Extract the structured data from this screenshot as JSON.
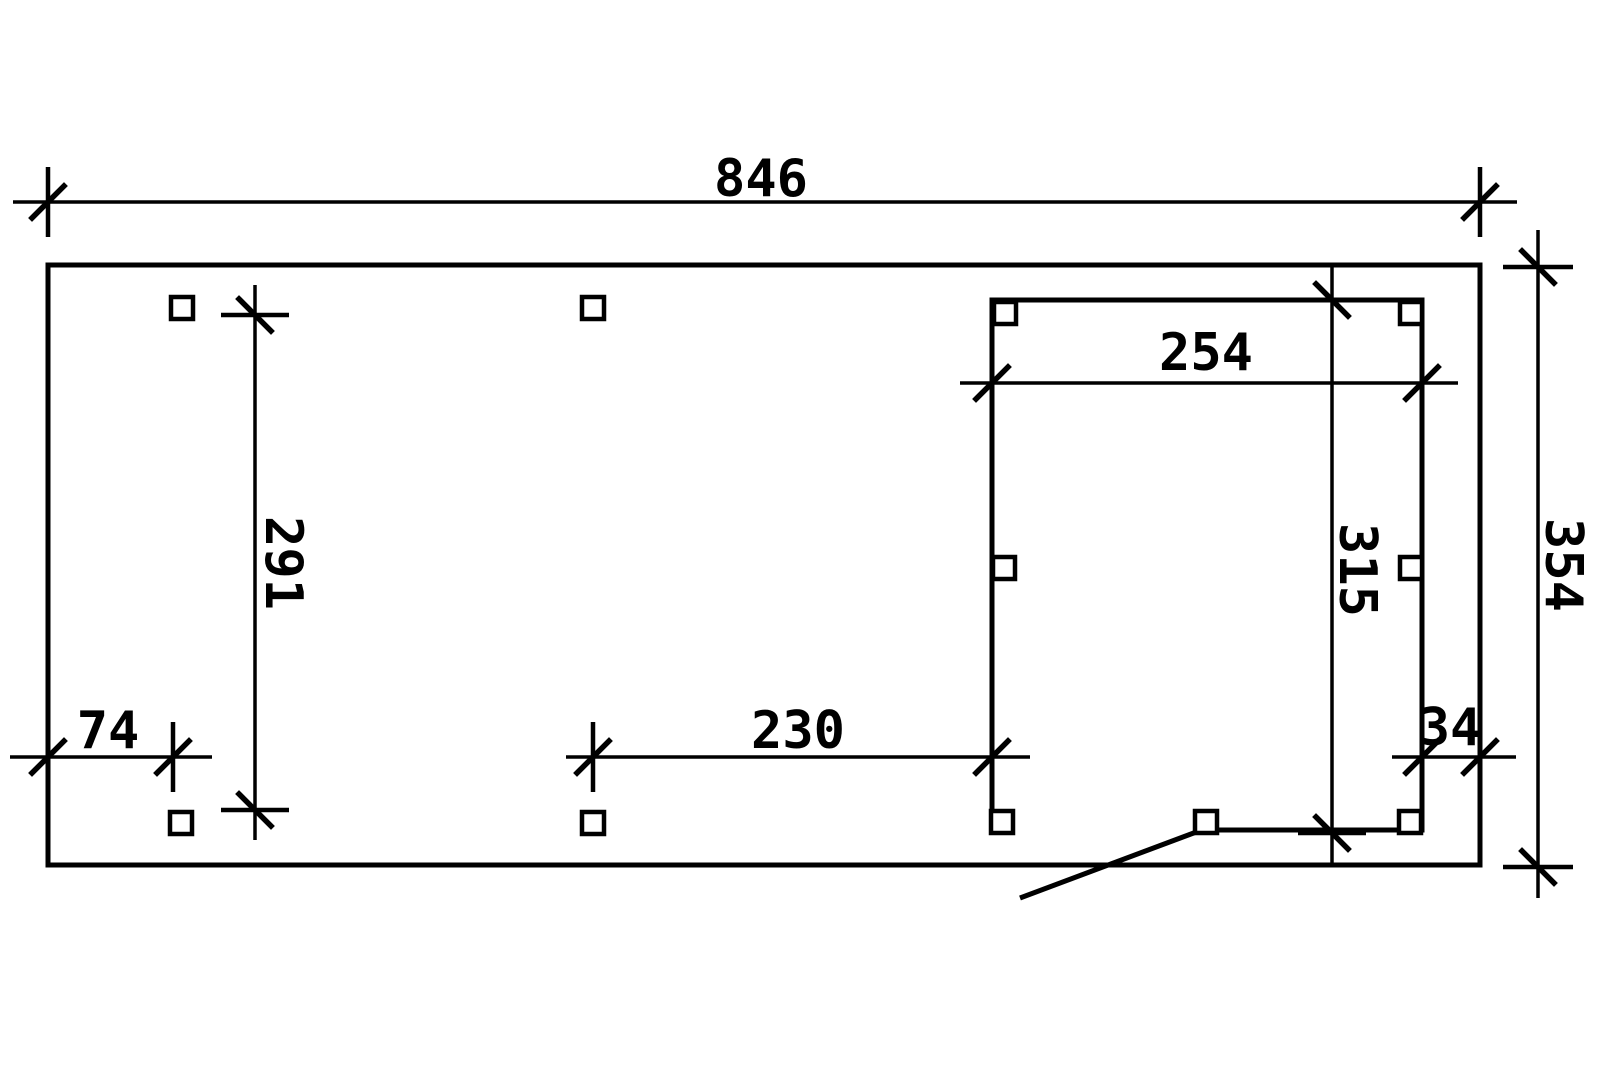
{
  "drawing": {
    "type": "floor-plan",
    "colors": {
      "background": "#ffffff",
      "line": "#000000"
    },
    "labels": {
      "total_width": "846",
      "total_depth": "354",
      "left_bay_depth": "291",
      "front_post_offset": "74",
      "middle_bay_width": "230",
      "room_width": "254",
      "room_depth": "315",
      "rear_post_offset": "34"
    },
    "dimensions": [
      {
        "id": "total-width",
        "value": 846,
        "orientation": "horizontal",
        "position": "top"
      },
      {
        "id": "total-depth",
        "value": 354,
        "orientation": "vertical",
        "position": "right"
      },
      {
        "id": "left-bay-depth",
        "value": 291,
        "orientation": "vertical",
        "position": "left-inside"
      },
      {
        "id": "front-post-offset",
        "value": 74,
        "orientation": "horizontal",
        "position": "bottom-left-inside"
      },
      {
        "id": "middle-bay-width",
        "value": 230,
        "orientation": "horizontal",
        "position": "bottom-middle-inside"
      },
      {
        "id": "room-width",
        "value": 254,
        "orientation": "horizontal",
        "position": "room-top"
      },
      {
        "id": "room-depth",
        "value": 315,
        "orientation": "vertical",
        "position": "room-right"
      },
      {
        "id": "rear-post-offset",
        "value": 34,
        "orientation": "horizontal",
        "position": "bottom-right-inside"
      }
    ],
    "posts": [
      {
        "x": 171,
        "y": 297
      },
      {
        "x": 582,
        "y": 297
      },
      {
        "x": 170,
        "y": 812
      },
      {
        "x": 582,
        "y": 812
      },
      {
        "x": 994,
        "y": 302
      },
      {
        "x": 1400,
        "y": 302
      },
      {
        "x": 993,
        "y": 557
      },
      {
        "x": 1400,
        "y": 557
      },
      {
        "x": 991,
        "y": 811
      },
      {
        "x": 1195,
        "y": 811
      },
      {
        "x": 1399,
        "y": 811
      }
    ],
    "post_size": 22
  }
}
